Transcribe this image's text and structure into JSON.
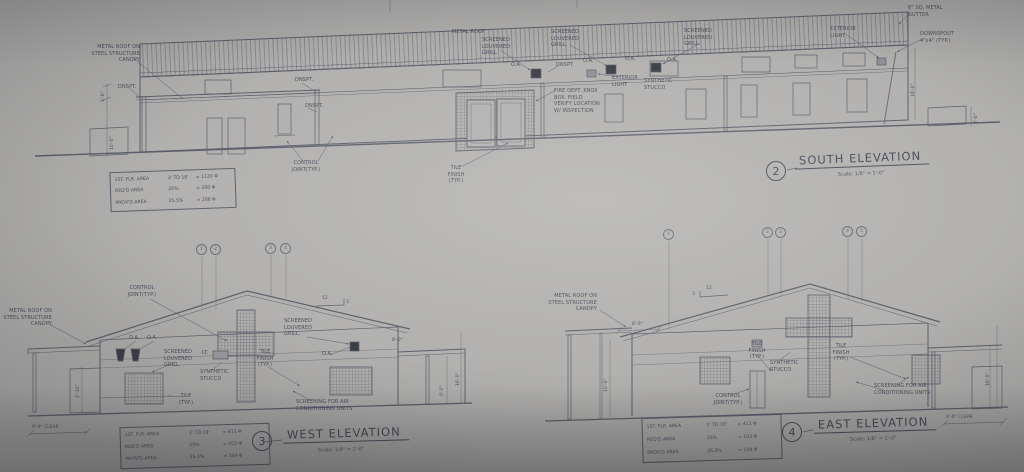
{
  "sheet": {
    "paper": "#b2b1af",
    "line": "#5d606c",
    "ink": "#4c4f5c"
  },
  "labels": {
    "metal_roof_canopy": "METAL ROOF ON\nSTEEL STRUCTURE\nCANOPY",
    "metal_roof": "METAL ROOF",
    "screened_grill": "SCREENED\nLOUVERED\nGRILL.",
    "dnspt": "DNSPT.",
    "oa": "O.A.",
    "lt": "LT.",
    "exterior_light": "EXTERIOR\nLIGHT",
    "knox_box": "FIRE DEPT. KNOX\nBOX. FIELD\nVERIFY LOCATION\nW/ INSPECTION",
    "synthetic_stucco": "SYNTHETIC\nSTUCCO",
    "control_joint": "CONTROL\nJOINT(TYP.)",
    "tile_finish": "TILE\nFINISH\n(TYP.)",
    "tile_typ": "TILE\n(TYP.)",
    "gutter": "6\" SQ. METAL\nGUTTER",
    "downspout": "DOWNSPOUT\n4\"x4\" (TYP.)",
    "ac_screening": "SCREENING FOR AIR\nCONDITIONING UNITS",
    "slope_rise": "12",
    "slope_run": "3"
  },
  "dims": {
    "h_1_6": "1'-6\"",
    "h_10_0": "10'-0\"",
    "h_16_0": "16'-0\"",
    "h_3_0": "3'-0\"",
    "h_8_0": "8'-0\"",
    "h_9_0_clear": "9'-0\" CLEAR",
    "h_2_10": "2'-10\"",
    "h_5_0": "5'-0\""
  },
  "south": {
    "number": "2",
    "title": "SOUTH ELEVATION",
    "scale": "Scale: 1/8\" = 1'-0\"",
    "table": {
      "rows": [
        [
          "1ST. FLR. AREA",
          "2' TO 10'",
          "= 1120 Φ"
        ],
        [
          "REQ'D AREA",
          "25%",
          "= 280 Φ"
        ],
        [
          "PROV'D AREA",
          "25.5%",
          "= 286 Φ"
        ]
      ]
    }
  },
  "west": {
    "number": "3",
    "title": "WEST ELEVATION",
    "scale": "Scale: 1/8\" = 1'-0\"",
    "grid_bubbles": [
      "1",
      "2",
      "3",
      "4"
    ],
    "table": {
      "rows": [
        [
          "1ST. FLR. AREA",
          "2' TO 10'",
          "= 411 Φ"
        ],
        [
          "REQ'D AREA",
          "25%",
          "= 103 Φ"
        ],
        [
          "PROV'D AREA",
          "25.3%",
          "= 104 Φ"
        ]
      ]
    }
  },
  "east": {
    "number": "4",
    "title": "EAST ELEVATION",
    "scale": "Scale: 1/8\" = 1'-0\"",
    "grid_bubbles": [
      "1",
      "2",
      "3",
      "4",
      "5"
    ],
    "table": {
      "rows": [
        [
          "1ST. FLR. AREA",
          "2' TO 10'",
          "= 411 Φ"
        ],
        [
          "REQ'D AREA",
          "25%",
          "= 103 Φ"
        ],
        [
          "PROV'D AREA",
          "25.3%",
          "= 104 Φ"
        ]
      ]
    }
  }
}
